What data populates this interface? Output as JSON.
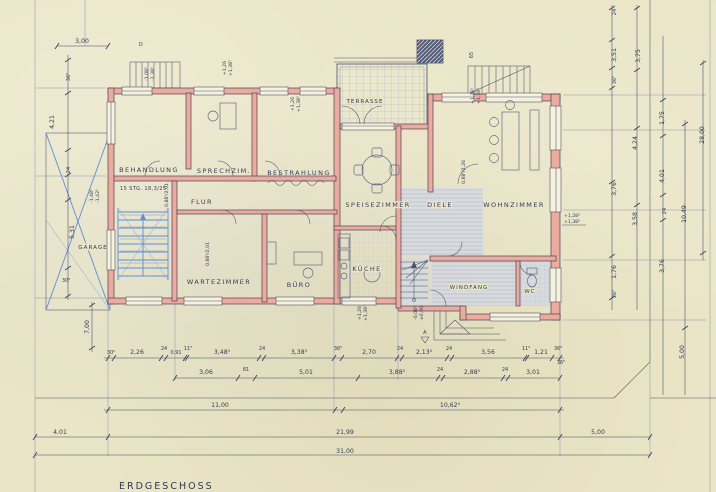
{
  "sheet": {
    "title": "ERDGESCHOSS"
  },
  "rooms": {
    "behandlung": "BEHANDLUNG",
    "sprechzimmer": "SPRECHZIM.",
    "bestrahlung": "BESTRAHLUNG",
    "terrasse": "TERRASSE",
    "speisezimmer": "SPEISEZIMMER",
    "diele": "DIELE",
    "wohnzimmer": "WOHNZIMMER",
    "flur": "FLUR",
    "wartezimmer": "WARTEZIMMER",
    "buero": "BÜRO",
    "kueche": "KÜCHE",
    "windfang": "WINDFANG",
    "garage": "GARAGE",
    "wc": "WC"
  },
  "annotations": {
    "stair_note": "15 STG. 18,3/25",
    "stair_width": "65",
    "section_a": "A",
    "section_d": "D"
  },
  "door_tags": {
    "d1": "0,88⁵/2,01",
    "d2": "0,88⁵/2,01",
    "d3": "0,88⁵/2,26"
  },
  "levels": {
    "l1a": "-1,08⁵",
    "l1b": "-1,38⁵",
    "l2a": "+1,26",
    "l2b": "+1,38⁵",
    "l3a": "+1,26",
    "l3b": "+1,38⁵",
    "l4a": "+1,28⁵",
    "l4b": "+1,38⁵",
    "l5a": "-1,48⁵",
    "l5b": "-1,42⁵",
    "l6a": "+1,28⁵",
    "l6b": "+1,38⁵",
    "l7a": "+1,26",
    "l7b": "+1,38⁵",
    "l8a": "-0,08⁵",
    "l8b": "±0,00"
  },
  "dims": {
    "row1": [
      "30⁵",
      "2,26",
      "24",
      "0,91",
      "11⁵",
      "3,48⁵",
      "24",
      "3,38⁵",
      "36⁵",
      "2,70",
      "24",
      "2,13⁵",
      "24",
      "3,56",
      "11⁵",
      "1,21",
      "36⁵"
    ],
    "row2": [
      "3,06",
      "81",
      "5,01",
      "3,88⁵",
      "24",
      "2,88⁵",
      "24",
      "3,01"
    ],
    "row3": [
      "11,00",
      "10,62⁵"
    ],
    "row4": [
      "4,01",
      "21,99",
      "5,00"
    ],
    "row5": [
      "31,00"
    ],
    "top": [
      "3,00"
    ],
    "left": [
      "36⁵",
      "4,21",
      "24",
      "5,31",
      "30⁵",
      "7,00"
    ],
    "right": [
      "24",
      "3,51",
      "3,75",
      "36⁵",
      "1,75",
      "4,24",
      "28,00",
      "4,01",
      "3,76",
      "3,58",
      "24",
      "10,49",
      "1,76",
      "36⁵",
      "3,76",
      "5,00",
      "36⁵"
    ]
  },
  "colors": {
    "wall": "#ecab9f",
    "ink": "#49536e",
    "blue": "#5b8fd4",
    "paper": "#eae5c6"
  }
}
